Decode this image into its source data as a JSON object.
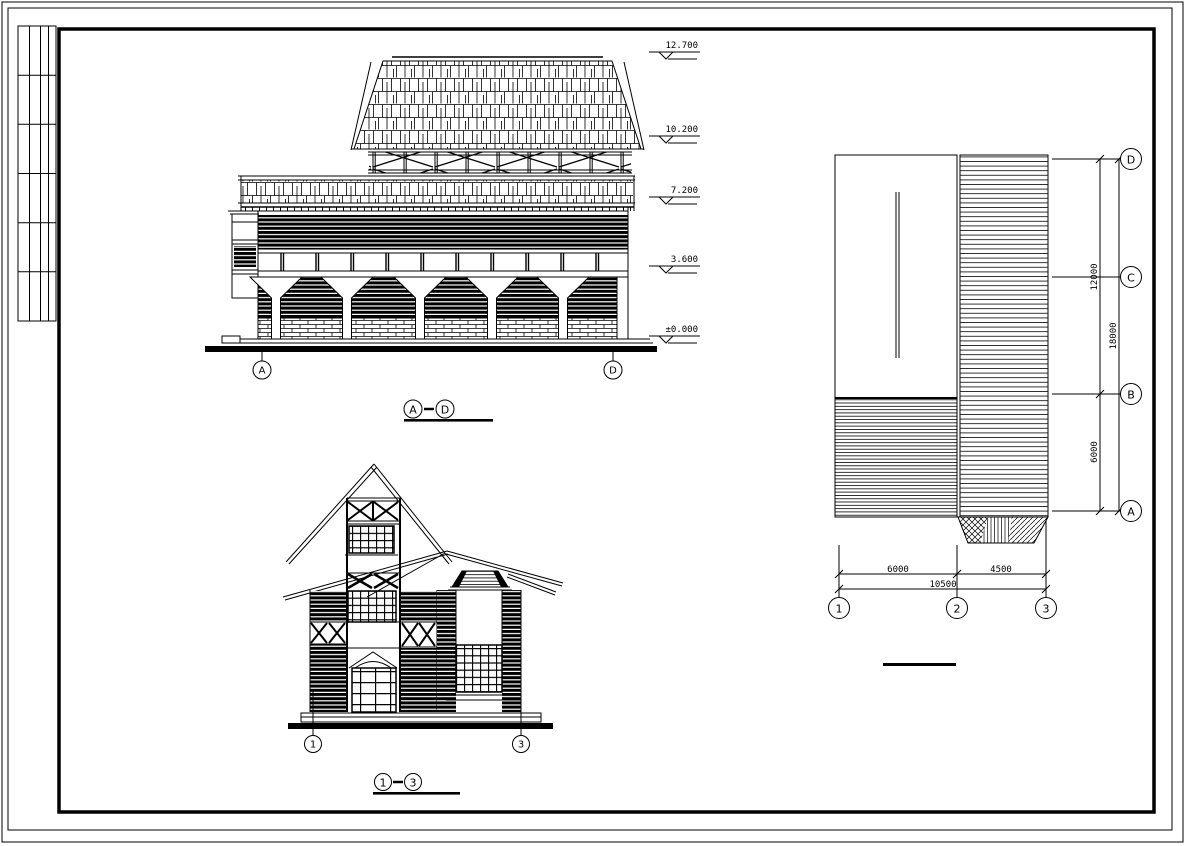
{
  "app": {
    "background_color": "#ffffff",
    "line_color": "#000000",
    "description": "CAD architectural drawing sheet with two elevations and a roof plan"
  },
  "elevation_ad": {
    "levels": [
      "12.700",
      "10.200",
      "7.200",
      "3.600",
      "±0.000"
    ],
    "grid": [
      "A",
      "D"
    ],
    "title": [
      "A",
      "D"
    ]
  },
  "elevation_13": {
    "grid": [
      "1",
      "3"
    ],
    "title": [
      "1",
      "3"
    ]
  },
  "roof_plan": {
    "rows": [
      "D",
      "C",
      "B",
      "A"
    ],
    "row_dims": [
      "12000",
      "6000"
    ],
    "row_total": "18000",
    "cols": [
      "1",
      "2",
      "3"
    ],
    "col_dims": [
      "6000",
      "4500"
    ],
    "col_total": "10500"
  }
}
